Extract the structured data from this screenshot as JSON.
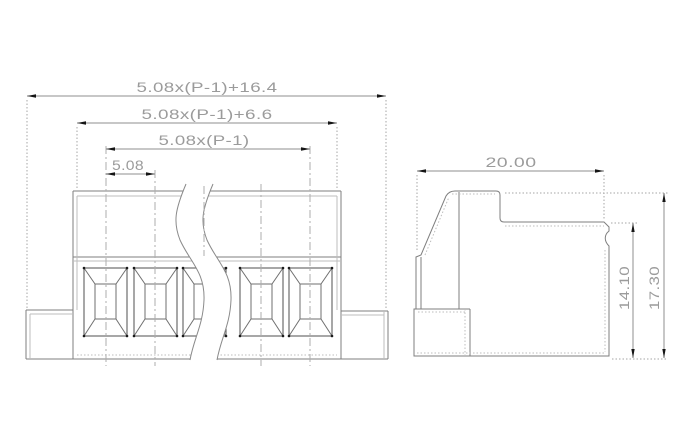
{
  "colors": {
    "background": "#ffffff",
    "outline": "#7f7f7f",
    "outline_light": "#bdbdbd",
    "opening_outline": "#4f4f4f",
    "opening_detail": "#6f6f6f",
    "corner_dot": "#1a1a1a",
    "break_line": "#8a8a8a",
    "centerline": "#aeaeae",
    "extension_line": "#a6a6a6",
    "dimension_line": "#8f8f8f",
    "text": "#9b9b9b",
    "arrow": "#151515"
  },
  "views": {
    "front": {
      "openings_visible": 5,
      "dimensions": {
        "overall_width": "5.08x(P-1)+16.4",
        "housing_width": "5.08x(P-1)+6.6",
        "contact_span": "5.08x(P-1)",
        "pitch": "5.08"
      }
    },
    "side": {
      "dimensions": {
        "top_width": "20.00",
        "front_height": "14.10",
        "overall_height": "17.30"
      }
    }
  }
}
